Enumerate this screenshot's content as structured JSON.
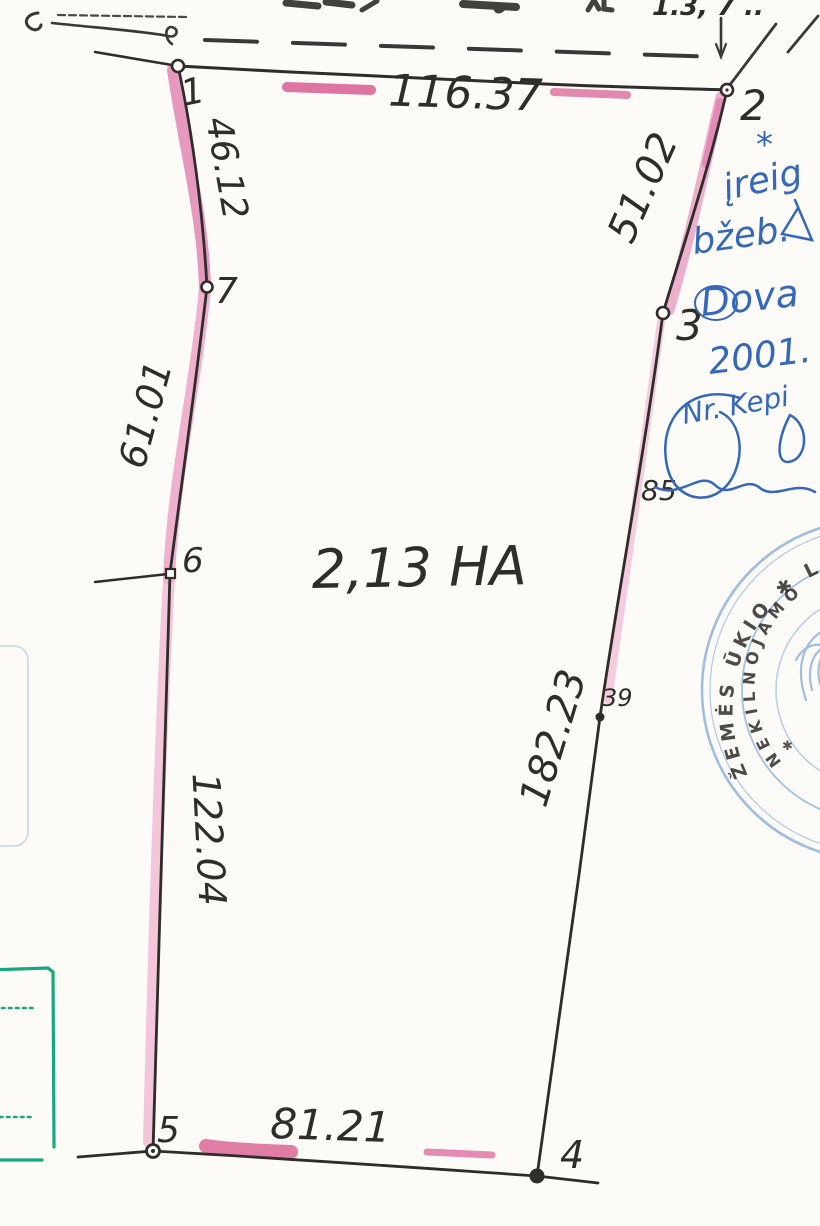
{
  "parcel": {
    "area_label": "2,13 HA",
    "vertex_labels": {
      "v1": "1",
      "v2": "2",
      "v3": "3",
      "v4": "4",
      "v5": "5",
      "v6": "6",
      "v7": "7",
      "p85": "85",
      "p39": "39"
    },
    "measurements": {
      "side_1_2": "116.37",
      "side_2_3": "51.02",
      "side_3_4": "182.23",
      "side_4_5": "81.21",
      "side_5_6": "122.04",
      "side_6_7": "61.01",
      "side_7_1": "46.12"
    }
  },
  "notes": {
    "asterisk": "*",
    "line1": "įreig",
    "line2": "bžeb.",
    "line3": "Dova",
    "line4": "2001.",
    "line5": "Nr. Kepi"
  },
  "top_fragment": "1.3, 7 ..",
  "stamp": {
    "outer_text": "ŽEMĖS ŪKIO ✱ LIETU",
    "inner_text": "NEKILNOJAMO",
    "star": "✱"
  },
  "colors": {
    "line": "#2f2d2a",
    "pink_light": "#f0b4cf",
    "pink_strong": "#d6538a",
    "blue_ink": "#3567bb",
    "stamp_blue": "#7fa8d8",
    "teal": "#17a87e"
  }
}
